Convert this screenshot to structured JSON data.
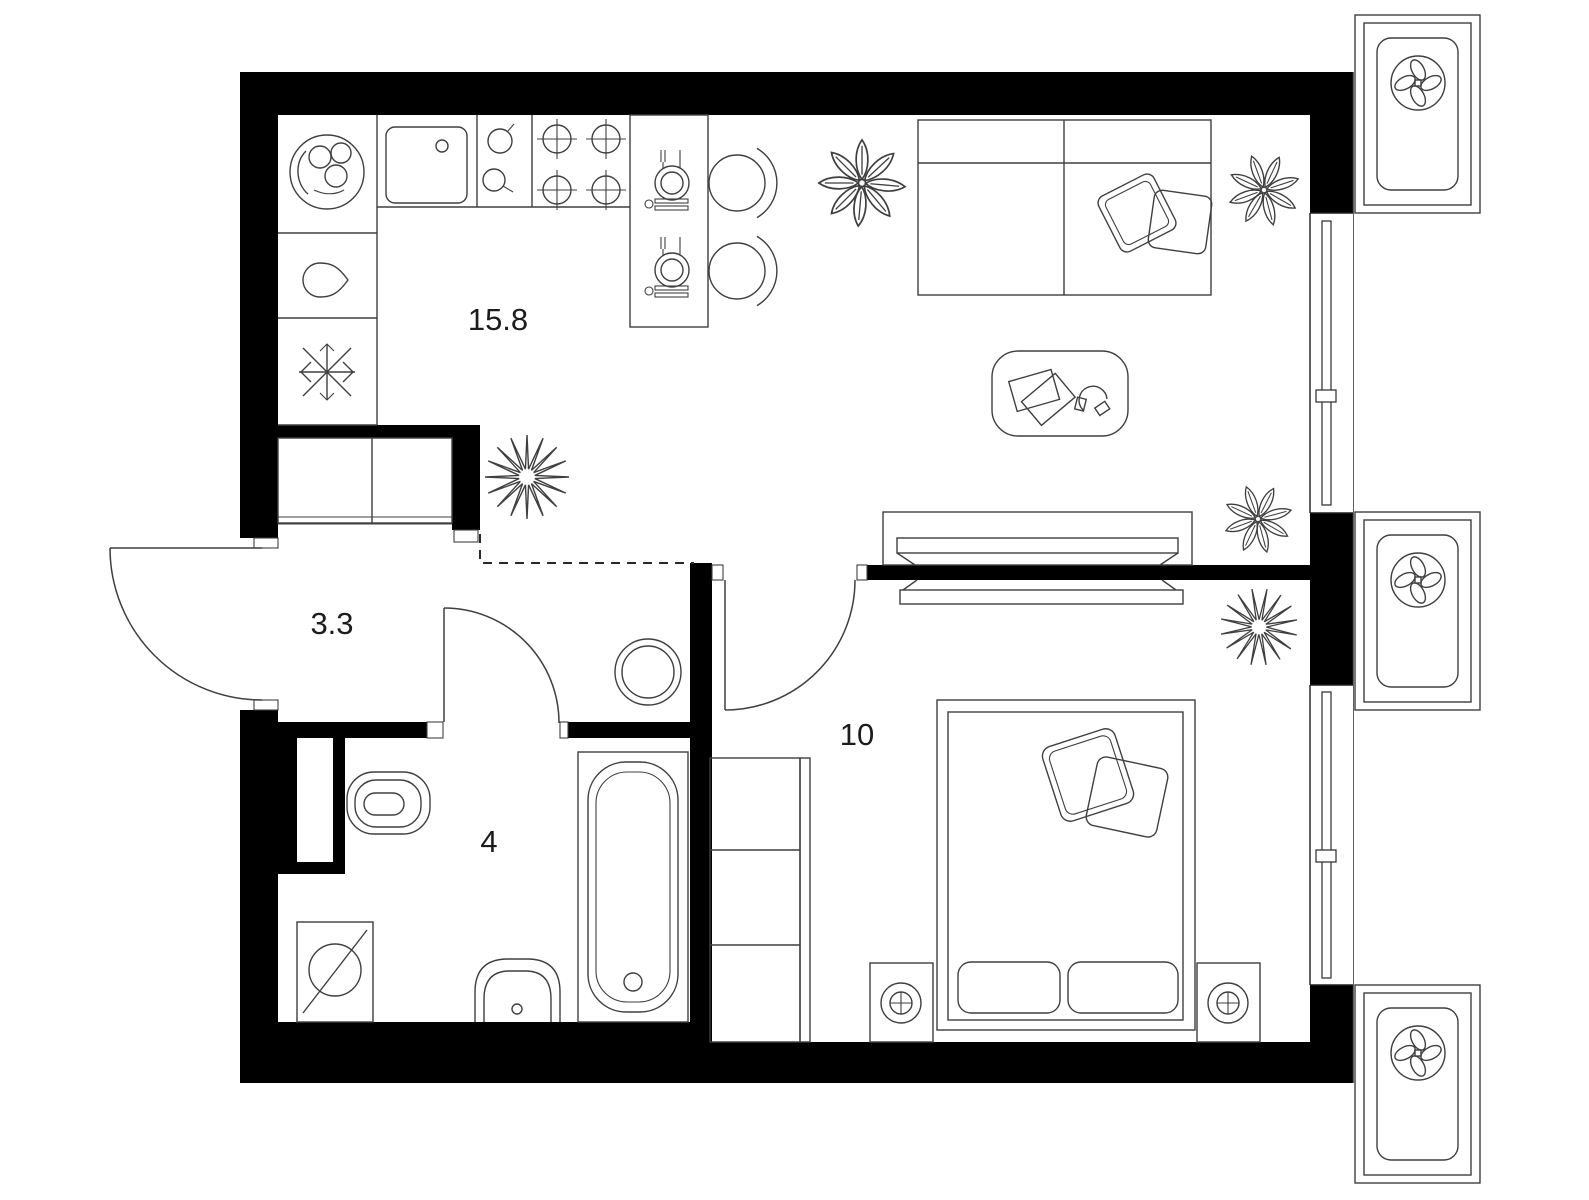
{
  "plan": {
    "type": "apartment-floor-plan",
    "units": "square-meters"
  },
  "colors": {
    "wall": "#000000",
    "floor": "#ffffff",
    "line": "#3f3f3f",
    "text": "#1c1c1c"
  },
  "rooms": [
    {
      "id": "kitchen-living-room",
      "area_label": "15.8"
    },
    {
      "id": "hallway",
      "area_label": "3.3"
    },
    {
      "id": "bathroom",
      "area_label": "4"
    },
    {
      "id": "bedroom",
      "area_label": "10"
    }
  ],
  "icons": [
    "dish-rack-icon",
    "kettle-drop-icon",
    "fridge-snowflake-icon",
    "kitchen-sink-icon",
    "hob-pots-icon",
    "stove-burner-icon",
    "dining-table",
    "chair",
    "place-setting-icon",
    "sofa",
    "sofa-pillow",
    "coffee-table",
    "books-icon",
    "headphones-icon",
    "tv-console",
    "tv-dresser",
    "plant-leafy-icon",
    "plant-spiky-icon",
    "hall-wardrobe",
    "round-pouf",
    "bathroom-door-swing",
    "entrance-door-swing",
    "bedroom-door-swing",
    "toilet-icon",
    "washing-machine-icon",
    "bathroom-sink-icon",
    "bathtub-icon",
    "bed",
    "bed-pillow",
    "blanket",
    "nightstand-lamp-icon",
    "bedroom-wardrobe",
    "window-glazing",
    "ac-fan-unit-icon",
    "vent-shaft"
  ]
}
